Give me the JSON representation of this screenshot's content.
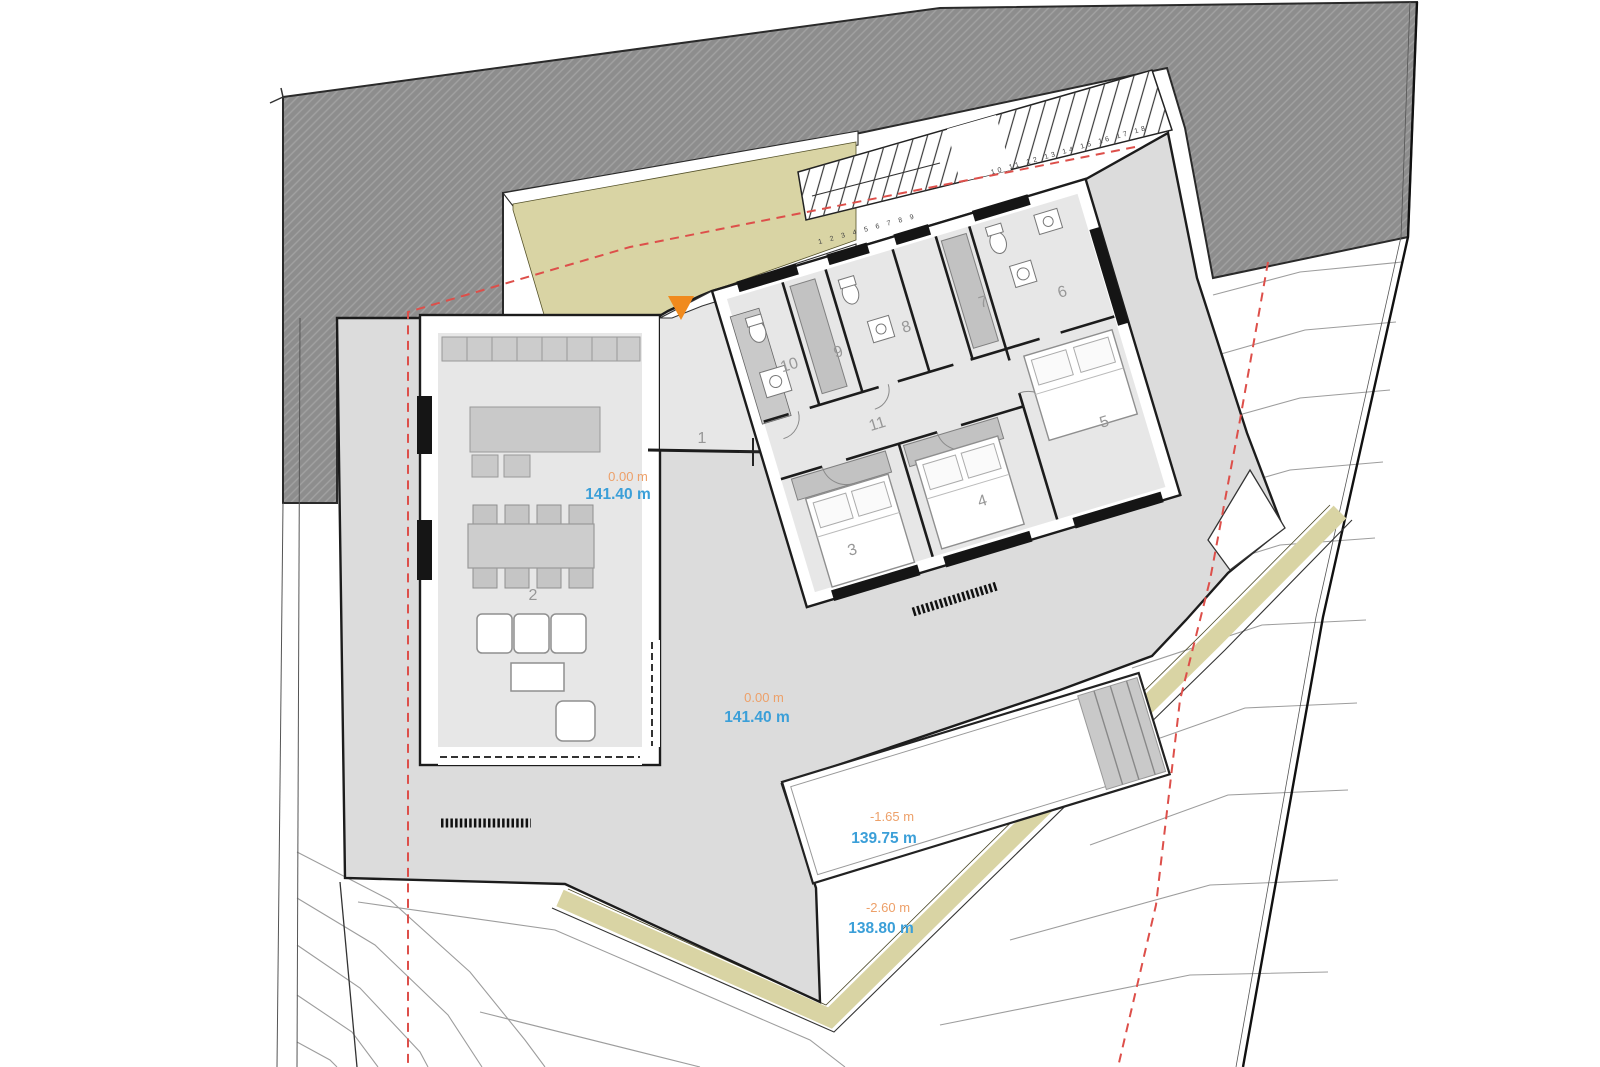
{
  "plan": {
    "type": "architectural site / floor plan",
    "rooms": [
      {
        "number": "1"
      },
      {
        "number": "2"
      },
      {
        "number": "3"
      },
      {
        "number": "4"
      },
      {
        "number": "5"
      },
      {
        "number": "6"
      },
      {
        "number": "7"
      },
      {
        "number": "8"
      },
      {
        "number": "9"
      },
      {
        "number": "10"
      },
      {
        "number": "11"
      }
    ],
    "elevations": [
      {
        "location": "living-room",
        "relative": "0.00 m",
        "absolute": "141.40 m"
      },
      {
        "location": "terrace",
        "relative": "0.00 m",
        "absolute": "141.40 m"
      },
      {
        "location": "pool",
        "relative": "-1.65 m",
        "absolute": "139.75 m"
      },
      {
        "location": "pool-deck",
        "relative": "-2.60 m",
        "absolute": "138.80 m"
      }
    ],
    "stairs": {
      "lower_steps": "1 2 3 4 5 6 7 8 9",
      "upper_steps": "10 11 12 13 14 15 16 17 18"
    },
    "colors": {
      "relative_elevation": "#eda069",
      "absolute_elevation": "#3b9fd8",
      "entrance_marker": "#f08a1d",
      "neighbor_fill": "#8d8d8d",
      "walkway_band": "#d9d4a4",
      "setback_line": "#dd4f4a",
      "terrace_fill": "#dcdcdc",
      "room_number": "#979797"
    }
  }
}
